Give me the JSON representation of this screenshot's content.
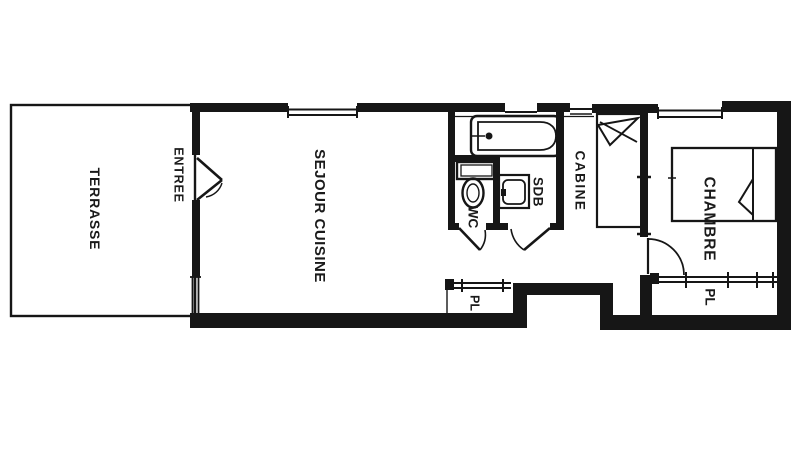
{
  "document": {
    "type": "floor-plan",
    "style": "scanned black-ink architectural drawing"
  },
  "colors": {
    "ink": "#161616",
    "paper": "#ffffff"
  },
  "rooms": {
    "terrasse": "TERRASSE",
    "entree": "ENTREE",
    "sejour_cuisine": "SEJOUR CUISINE",
    "wc": "WC",
    "sdb": "SDB",
    "cabine": "CABINE",
    "chambre": "CHAMBRE",
    "placard_hall": "PL",
    "placard_chambre": "PL"
  },
  "fixtures": [
    "bathtub",
    "toilet",
    "washbasin",
    "bunk-bed",
    "double-bed",
    "sliding-closet-left",
    "sliding-closet-right",
    "entrance-door",
    "wc-door",
    "sdb-door",
    "chambre-door",
    "windows"
  ]
}
